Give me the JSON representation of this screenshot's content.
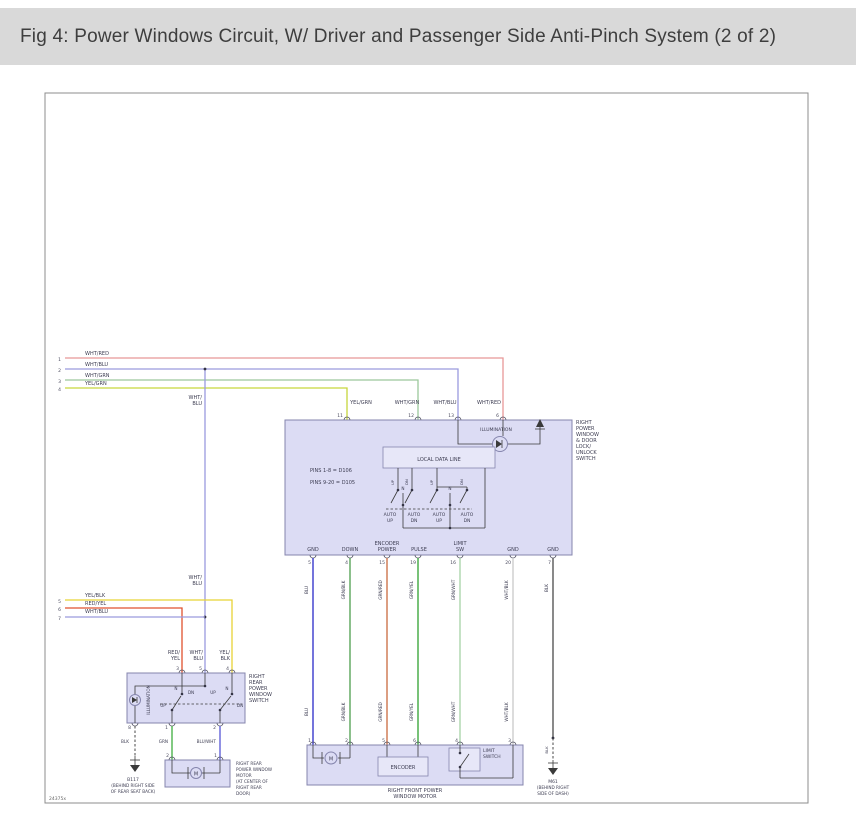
{
  "header": {
    "title": "Fig 4: Power Windows Circuit, W/ Driver and Passenger Side Anti-Pinch System (2 of 2)"
  },
  "diagram": {
    "ref_code": "24375x",
    "colors": {
      "wht_red": "#e89898",
      "wht_blu": "#9a9ade",
      "wht_grn": "#9cc89c",
      "yel_grn": "#c6d63c",
      "yel_blk": "#e8d335",
      "red_yel": "#e0522e",
      "blu": "#2a2ac8",
      "grn_blk": "#4d9e4d",
      "grn_red": "#c96a3f",
      "grn_yel": "#2fa12f",
      "grn_wht": "#a6d3a6",
      "wht_blk": "#c9c9c9",
      "blk": "#4a4a4a",
      "grn": "#3fae3f",
      "blu_wht": "#5656d6"
    },
    "top_feeds": [
      {
        "pin": "1",
        "wire": "WHT/RED"
      },
      {
        "pin": "2",
        "wire": "WHT/BLU"
      },
      {
        "pin": "3",
        "wire": "WHT/GRN"
      },
      {
        "pin": "4",
        "wire": "YEL/GRN"
      }
    ],
    "mid_feeds": [
      {
        "pin": "5",
        "wire": "YEL/BLK"
      },
      {
        "pin": "6",
        "wire": "RED/YEL"
      },
      {
        "pin": "7",
        "wire": "WHT/BLU"
      }
    ],
    "tap_label": [
      "WHT/",
      "BLU"
    ],
    "main_switch": {
      "name_lines": [
        "RIGHT",
        "POWER",
        "WINDOW",
        "& DOOR",
        "LOCK/",
        "UNLOCK",
        "SWITCH"
      ],
      "illumination": "ILLUMINATION",
      "local_data_line": "LOCAL DATA LINE",
      "pins_note": [
        "PINS 1-8 = D106",
        "PINS 9-20 = D105"
      ],
      "top_pins": [
        {
          "num": "11",
          "wire": "YEL/GRN"
        },
        {
          "num": "12",
          "wire": "WHT/GRN"
        },
        {
          "num": "13",
          "wire": "WHT/BLU"
        },
        {
          "num": "6",
          "wire": "WHT/RED"
        }
      ],
      "n_label": "N",
      "tip_labels": [
        "UP",
        "DN",
        "UP",
        "DN"
      ],
      "auto_labels": [
        [
          "AUTO",
          "UP"
        ],
        [
          "AUTO",
          "DN"
        ],
        [
          "AUTO",
          "UP"
        ],
        [
          "AUTO",
          "DN"
        ]
      ],
      "bottom_pins": [
        {
          "num": "5",
          "func": [
            "GND"
          ],
          "wire": "BLU"
        },
        {
          "num": "4",
          "func": [
            "DOWN"
          ],
          "wire": "GRN/BLK"
        },
        {
          "num": "15",
          "func": [
            "ENCODER",
            "POWER"
          ],
          "wire": "GRN/RED"
        },
        {
          "num": "19",
          "func": [
            "PULSE"
          ],
          "wire": "GRN/YEL"
        },
        {
          "num": "16",
          "func": [
            "LIMIT",
            "SW"
          ],
          "wire": "GRN/WHT"
        },
        {
          "num": "20",
          "func": [
            "GND"
          ],
          "wire": "WHT/BLK"
        },
        {
          "num": "7",
          "func": [
            "GND"
          ],
          "wire": "BLK"
        }
      ]
    },
    "rear_switch": {
      "name_lines": [
        "RIGHT",
        "REAR",
        "POWER",
        "WINDOW",
        "SWITCH"
      ],
      "illumination": "ILLUMINATION",
      "top_pins": [
        {
          "num": "3",
          "wire_lines": [
            "RED/",
            "YEL"
          ]
        },
        {
          "num": "5",
          "wire_lines": [
            "WHT/",
            "BLU"
          ]
        },
        {
          "num": "4",
          "wire_lines": [
            "YEL/",
            "BLK"
          ]
        }
      ],
      "pos": {
        "n": "N",
        "up": "UP",
        "dn": "DN"
      },
      "bottom_pins": [
        {
          "num": "8",
          "wire": "BLK"
        },
        {
          "num": "1",
          "wire": "GRN"
        },
        {
          "num": "2",
          "wire": "BLU/WHT"
        }
      ]
    },
    "rear_motor": {
      "pins": [
        "2",
        "1"
      ],
      "motor": "M",
      "name_lines": [
        "RIGHT REAR",
        "POWER WINDOW",
        "MOTOR",
        "(AT CENTER OF",
        "RIGHT REAR",
        "DOOR)"
      ]
    },
    "front_motor": {
      "pins": [
        "1",
        "2",
        "5",
        "6",
        "4",
        "3"
      ],
      "motor": "M",
      "encoder": "ENCODER",
      "limit_switch_lines": [
        "LIMIT",
        "SWITCH"
      ],
      "name_lines": [
        "RIGHT FRONT POWER",
        "WINDOW MOTOR"
      ]
    },
    "grounds": {
      "b117_lines": [
        "B117",
        "(BEHIND RIGHT SIDE",
        "OF REAR SEAT BACK)"
      ],
      "m61_lines": [
        "M61",
        "(BEHIND RIGHT",
        "SIDE OF DASH)"
      ]
    }
  }
}
